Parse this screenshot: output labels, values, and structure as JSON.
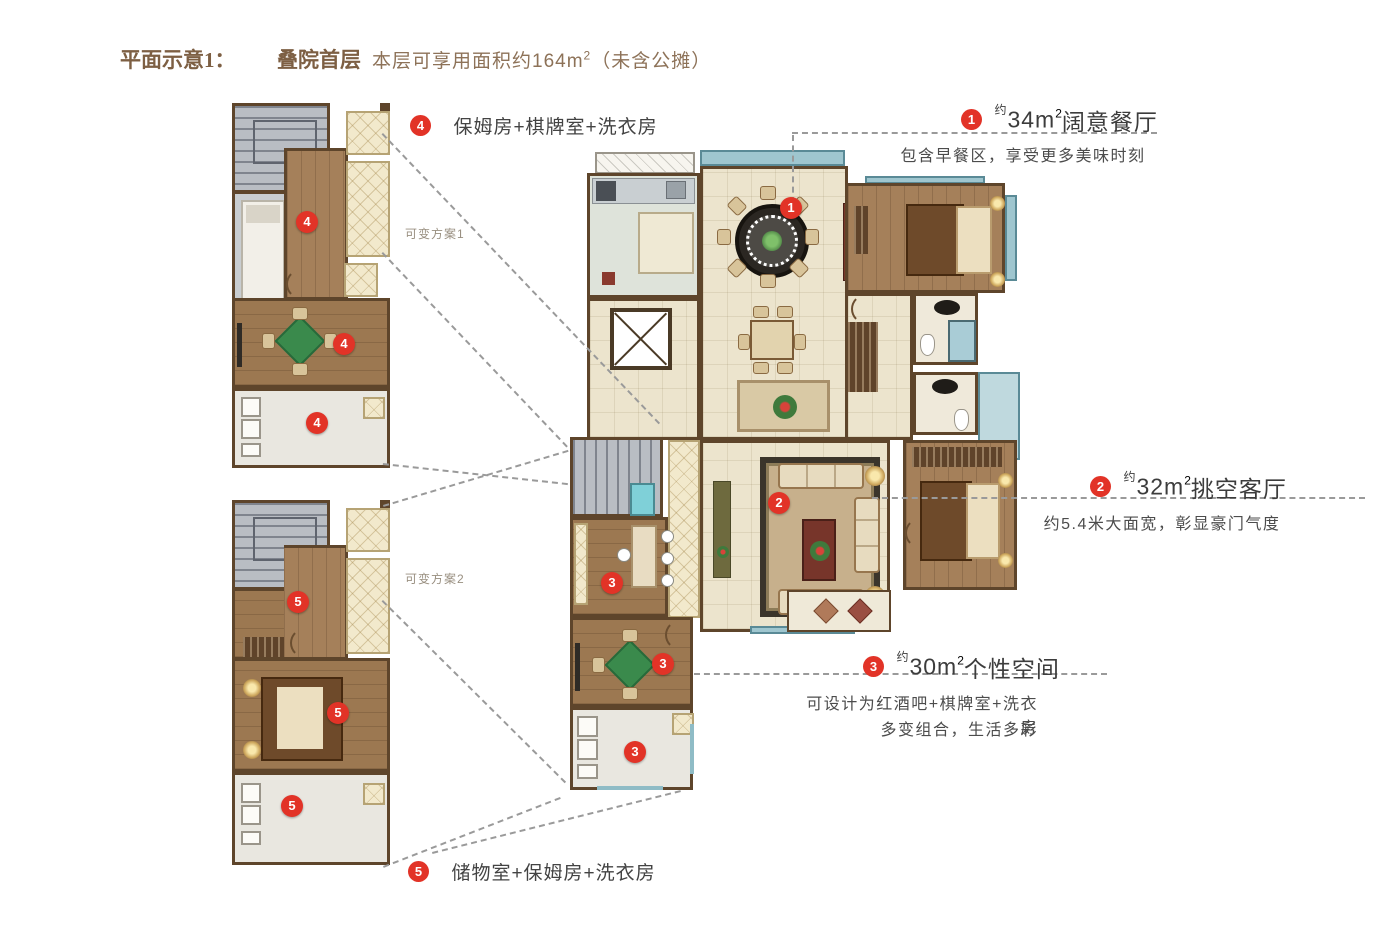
{
  "header": {
    "title_prefix": "平面示意1：",
    "title_name": "叠院首层",
    "desc_pre": "本层可享用面积约164m",
    "desc_sup": "2",
    "desc_post": "（未含公摊）"
  },
  "markers": {
    "n1": "1",
    "n2": "2",
    "n3": "3",
    "n4": "4",
    "n5": "5"
  },
  "annotations": {
    "a1": {
      "approx": "约",
      "area": "34m",
      "sup": "2",
      "name": "阔意餐厅",
      "desc": "包含早餐区，享受更多美味时刻"
    },
    "a2": {
      "approx": "约",
      "area": "32m",
      "sup": "2",
      "name": "挑空客厅",
      "desc": "约5.4米大面宽，彰显豪门气度"
    },
    "a3": {
      "approx": "约",
      "area": "30m",
      "sup": "2",
      "name": "个性空间",
      "desc1": "可设计为红酒吧+棋牌室+洗衣房",
      "desc2": "多变组合，生活多彩"
    },
    "a4": {
      "label": "保姆房+棋牌室+洗衣房"
    },
    "a5": {
      "label": "储物室+保姆房+洗衣房"
    }
  },
  "variants": {
    "v1": "可变方案1",
    "v2": "可变方案2"
  },
  "colors": {
    "accent_red": "#e23327",
    "wall_brown": "#5e452b",
    "title_brown": "#7d5f43",
    "text_dark": "#3c3c3c",
    "window_teal": "#9fc6cf",
    "table_green": "#3a8a4c"
  }
}
